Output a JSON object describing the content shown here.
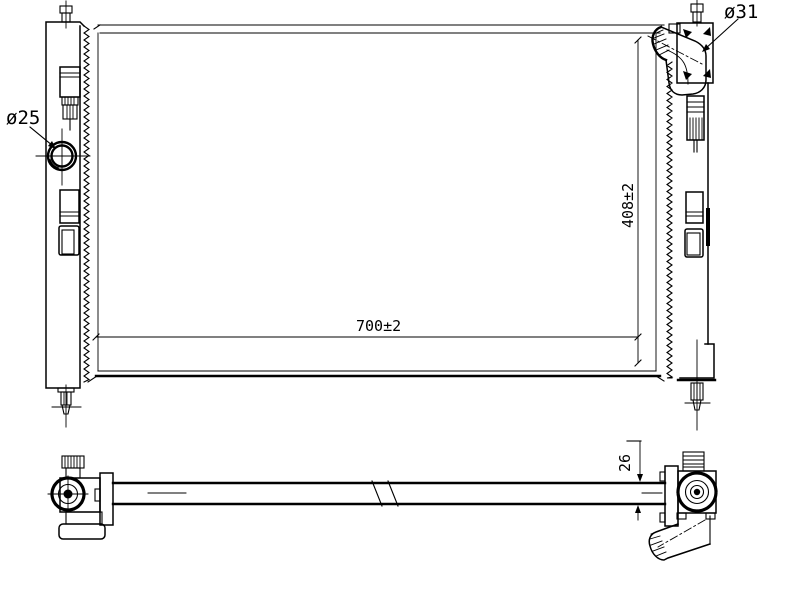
{
  "front_view": {
    "outlet_port_diameter_label": "ø25",
    "inlet_port_diameter_label": "ø31",
    "core_height_label": "408±2",
    "core_width_label": "700±2"
  },
  "bottom_view": {
    "core_depth_label": "26"
  }
}
